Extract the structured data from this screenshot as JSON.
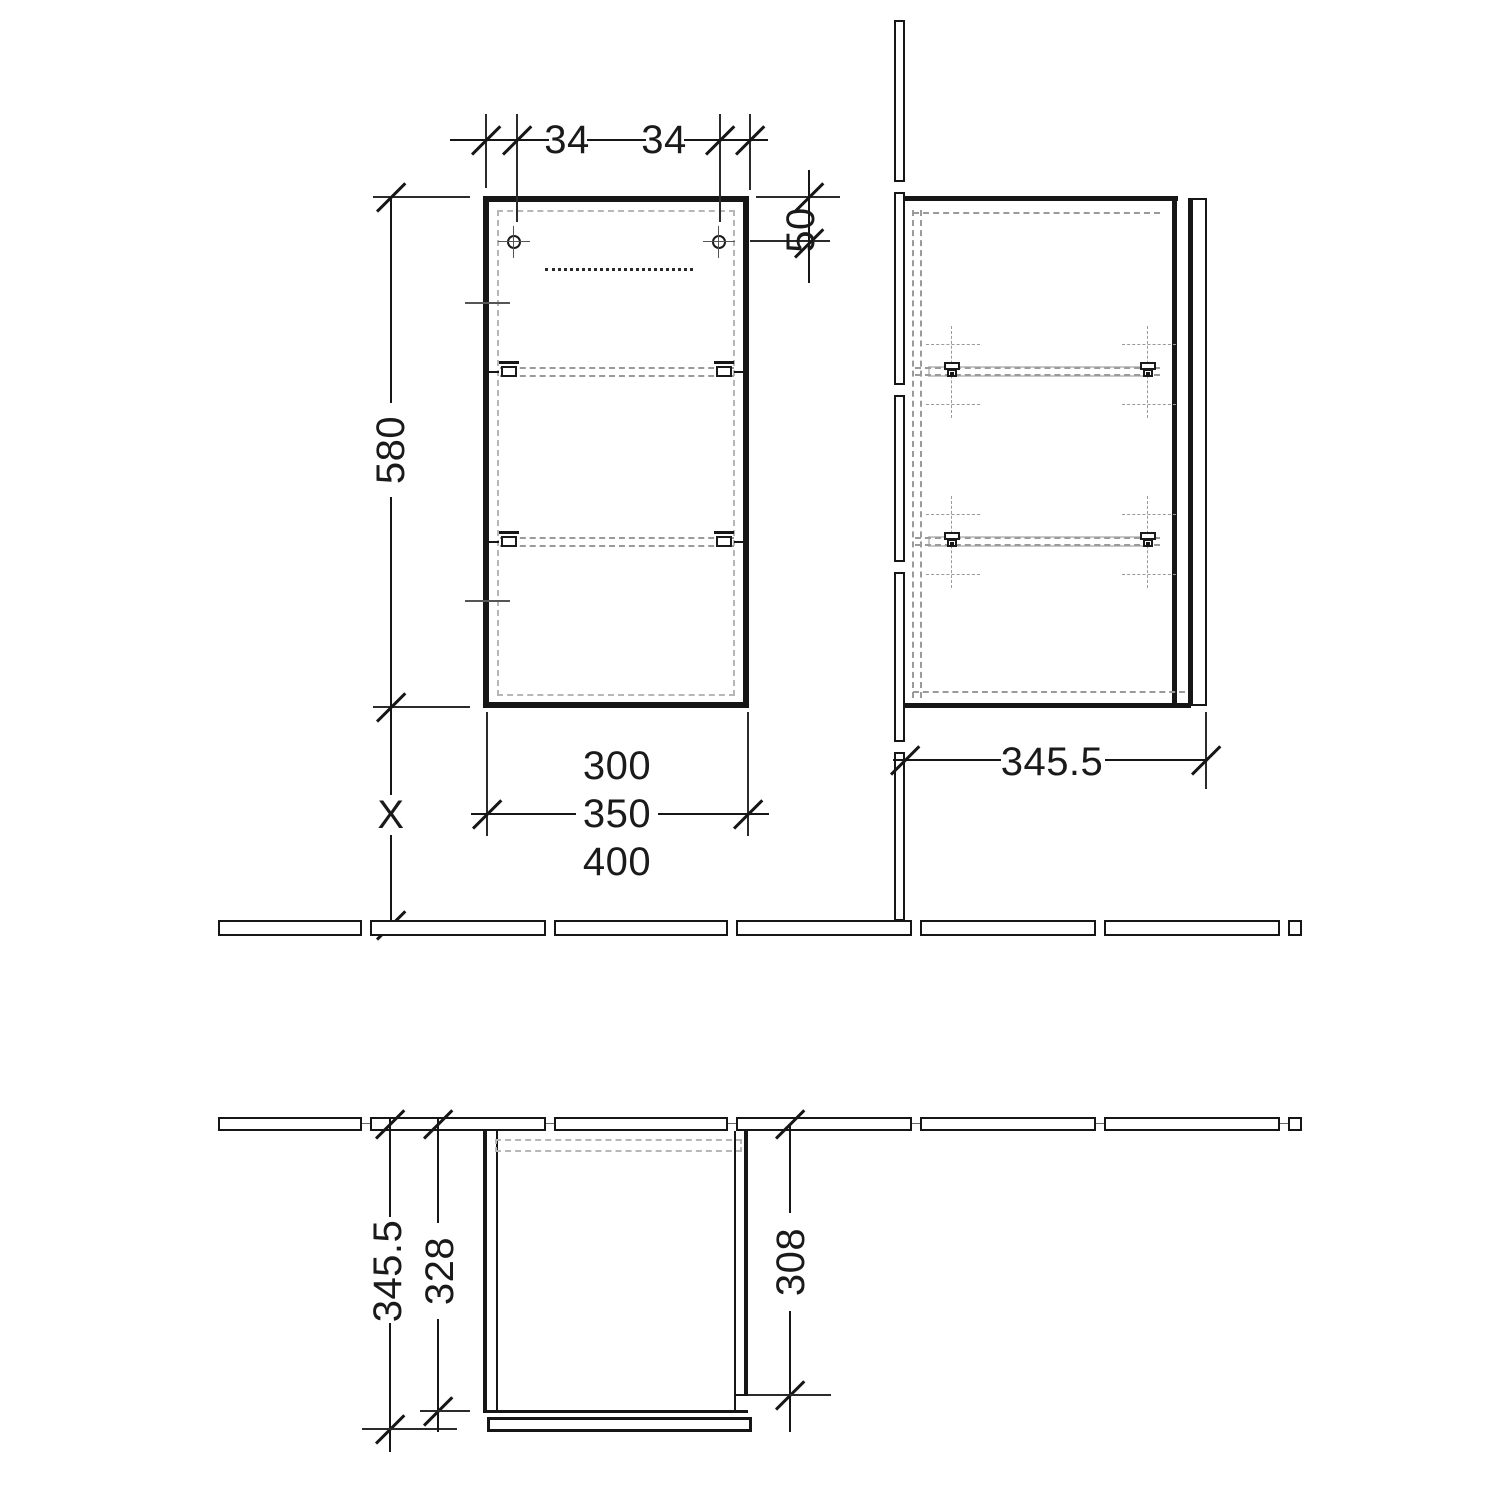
{
  "drawing": {
    "type": "cabinet installation drawing",
    "front_view": {
      "dim_hole_offset_left": "34",
      "dim_hole_offset_right": "34",
      "dim_hole_from_top": "50",
      "dim_height": "580",
      "dim_width_options": [
        "300",
        "350",
        "400"
      ],
      "dim_distance_to_floor": "X"
    },
    "side_view": {
      "dim_depth_overall": "345.5"
    },
    "plan_view": {
      "dim_depth_overall": "345.5",
      "dim_depth_body": "328",
      "dim_depth_side": "308"
    }
  }
}
